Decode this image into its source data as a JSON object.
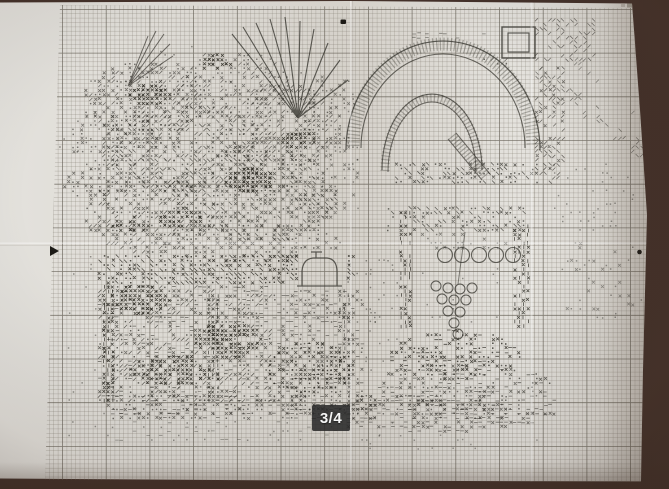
{
  "page_indicator": {
    "label": "3/4"
  },
  "photo": {
    "subject": "cross-stitch-pattern-chart-page"
  },
  "palette": {
    "background": "#44312a",
    "paper_light": "#e4e2dd",
    "paper_dark": "#d5d1ca",
    "grid_minor": "#7e776c",
    "grid_major": "#5e584e",
    "ink": "#3a3832",
    "ink_dark": "#232119",
    "marker": "#1c1a16",
    "smudge": "#9a948a",
    "badge_bg": "rgba(42,42,42,0.88)",
    "badge_text": "#f5f5f5"
  }
}
